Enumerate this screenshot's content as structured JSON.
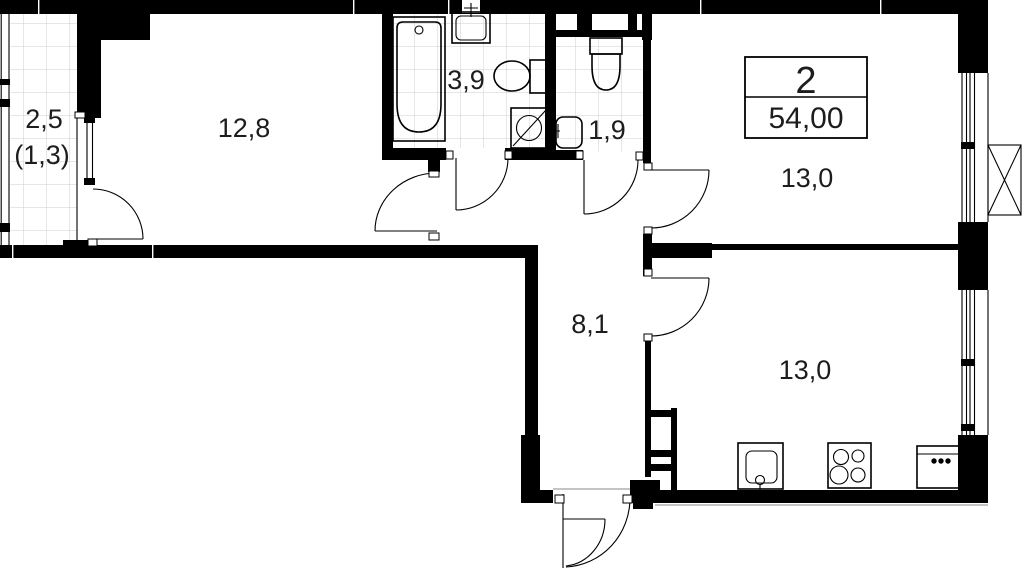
{
  "floor_plan": {
    "type": "apartment-plan",
    "title_block": {
      "room_count": "2",
      "total_area": "54,00"
    },
    "labels": {
      "balcony_area": "2,5",
      "balcony_area_reduced": "(1,3)",
      "living_room_area": "12,8",
      "bathroom_area": "3,9",
      "wc_area": "1,9",
      "bedroom_area": "13,0",
      "hallway_area": "8,1",
      "kitchen_area": "13,0"
    },
    "colors": {
      "walls": "#000000",
      "tile_grid": "#d6d6d6",
      "text": "#1d1d1d"
    }
  }
}
